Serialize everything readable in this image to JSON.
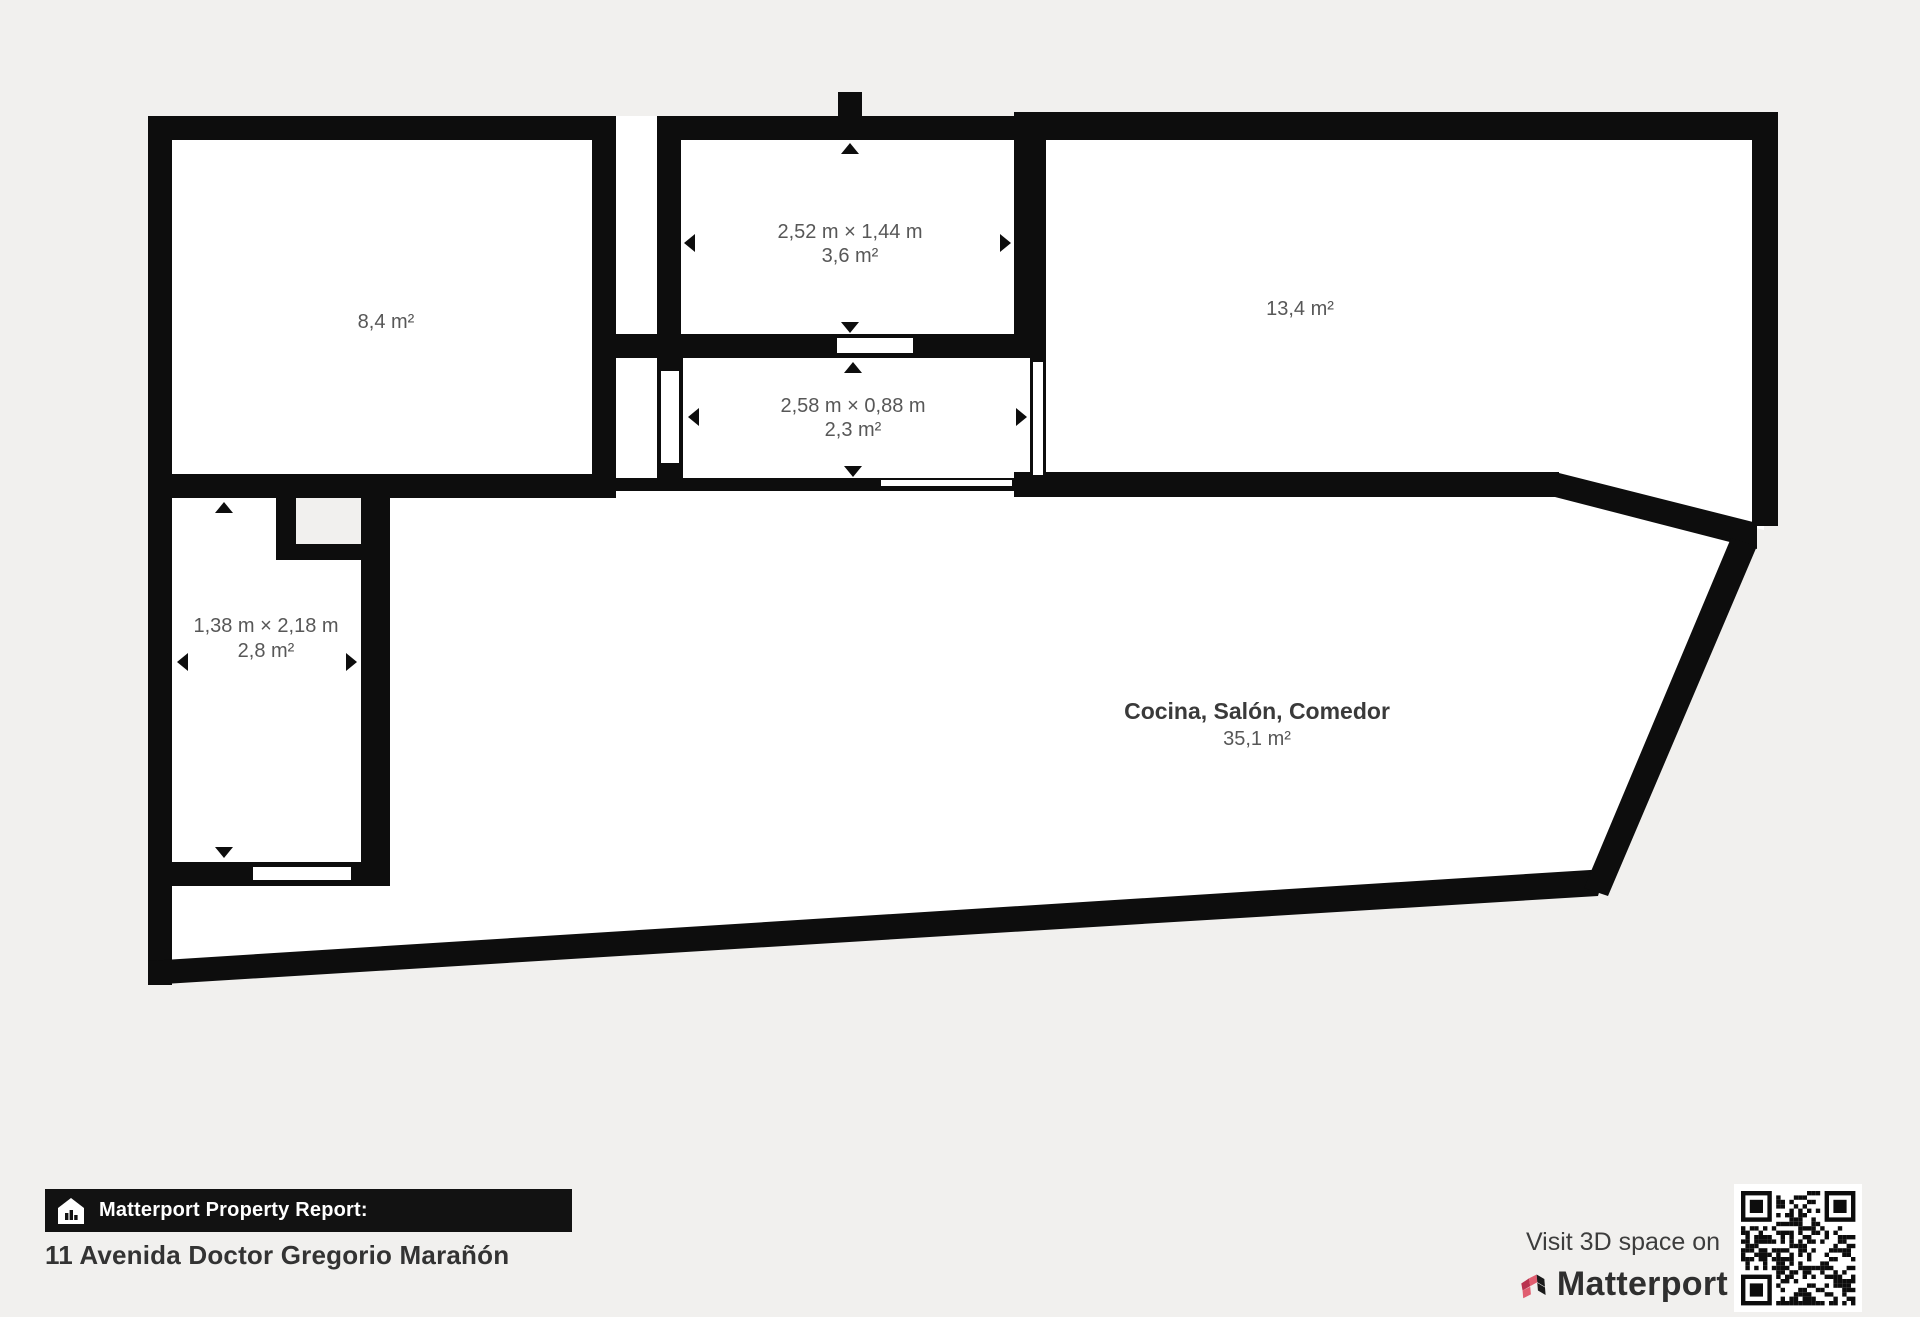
{
  "colors": {
    "background": "#f1f0ee",
    "wall": "#0d0d0d",
    "interior": "#ffffff",
    "dim_label": "#575757",
    "room_title": "#3a3a3a",
    "banner_bg": "#121212",
    "banner_text": "#ffffff",
    "brand_pink": "#e05d6f",
    "brand_red": "#b93350"
  },
  "rooms": {
    "room_a": {
      "area": "8,4 m²"
    },
    "room_b": {
      "dimensions": "2,52 m × 1,44 m",
      "area": "3,6 m²"
    },
    "room_c": {
      "area": "13,4 m²"
    },
    "hallway": {
      "dimensions": "2,58 m × 0,88 m",
      "area": "2,3 m²"
    },
    "room_d": {
      "dimensions": "1,38 m × 2,18 m",
      "area": "2,8 m²"
    },
    "living": {
      "name": "Cocina, Salón, Comedor",
      "area": "35,1 m²"
    }
  },
  "footer": {
    "report_label": "Matterport Property Report:",
    "address": "11 Avenida Doctor Gregorio Marañón",
    "visit_text": "Visit 3D space on",
    "brand": "Matterport"
  }
}
